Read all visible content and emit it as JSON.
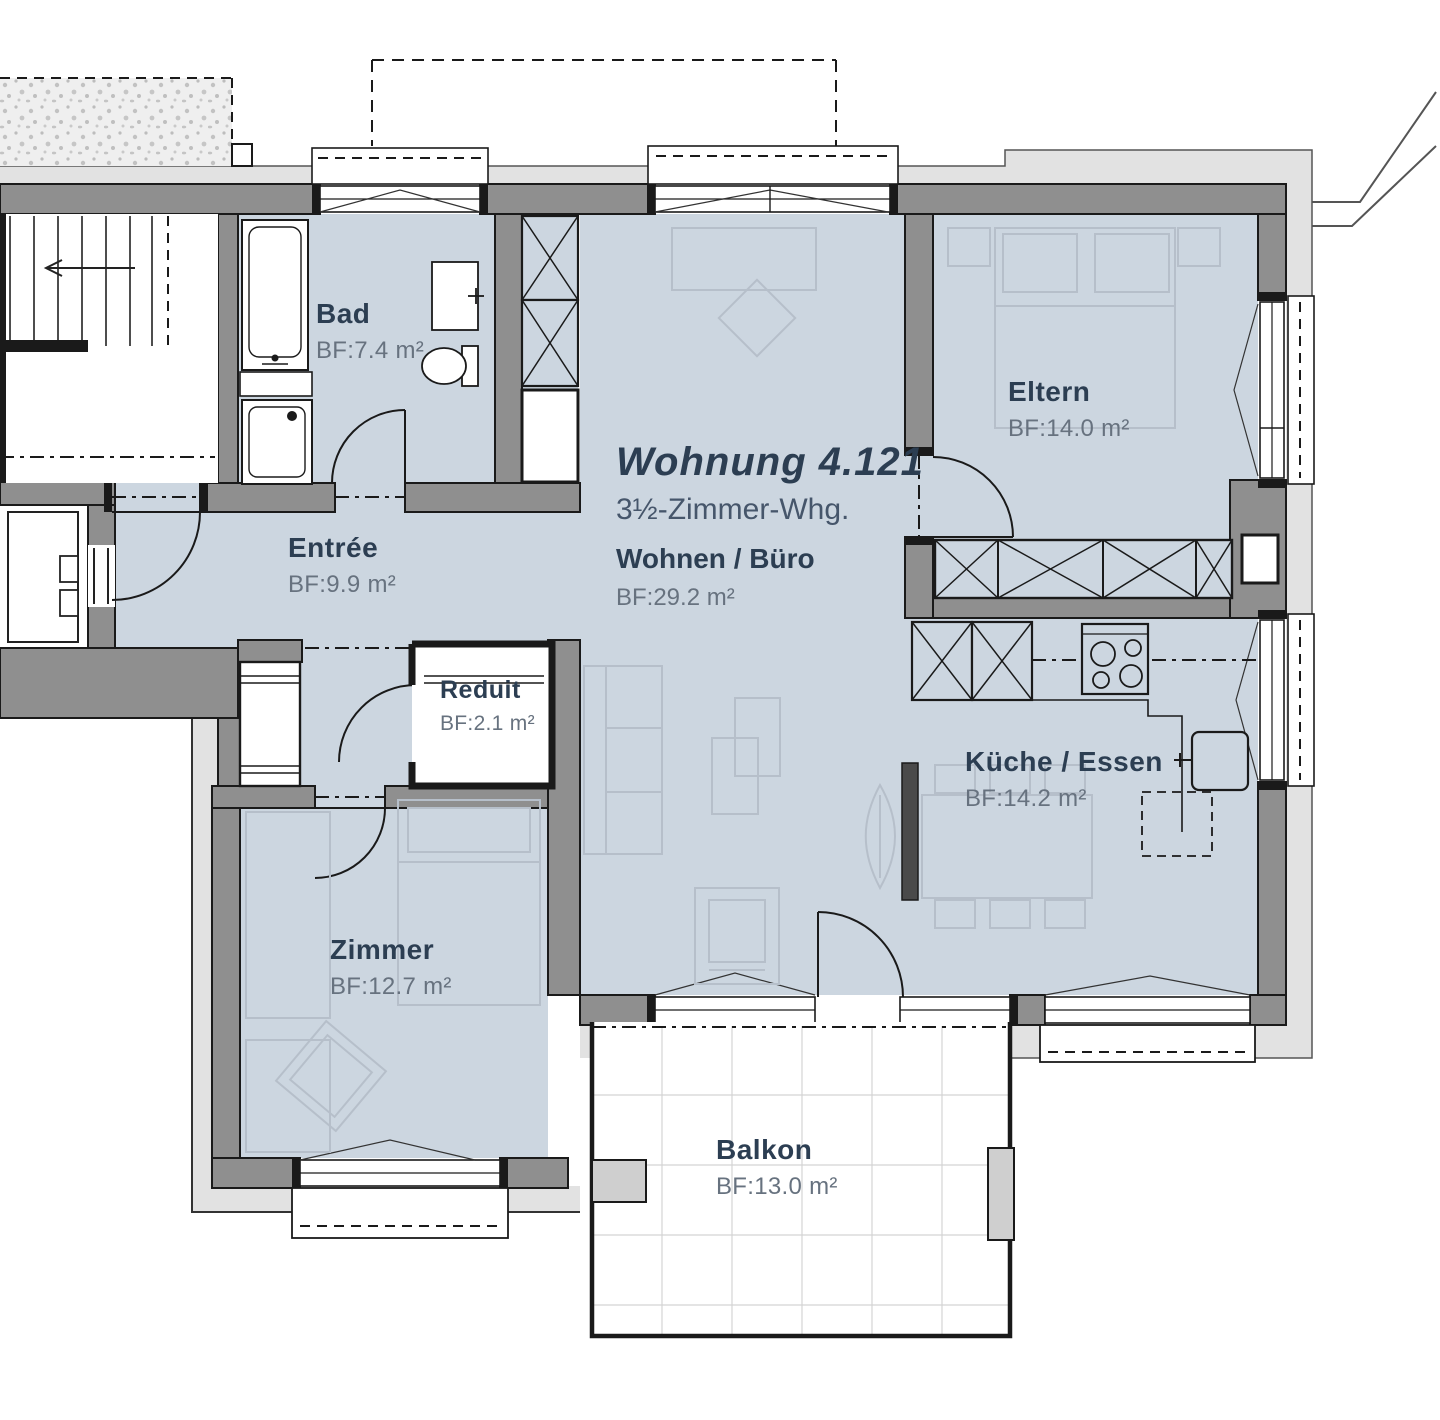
{
  "plan": {
    "title": "Wohnung 4.121",
    "subtitle": "3½-Zimmer-Whg."
  },
  "rooms": [
    {
      "id": "bad",
      "name": "Bad",
      "area": "BF:7.4 m²"
    },
    {
      "id": "entree",
      "name": "Entrée",
      "area": "BF:9.9 m²"
    },
    {
      "id": "reduit",
      "name": "Reduit",
      "area": "BF:2.1 m²"
    },
    {
      "id": "zimmer",
      "name": "Zimmer",
      "area": "BF:12.7 m²"
    },
    {
      "id": "wohnen",
      "name": "Wohnen / Büro",
      "area": "BF:29.2 m²"
    },
    {
      "id": "eltern",
      "name": "Eltern",
      "area": "BF:14.0 m²"
    },
    {
      "id": "kueche",
      "name": "Küche / Essen",
      "area": "BF:14.2 m²"
    },
    {
      "id": "balkon",
      "name": "Balkon",
      "area": "BF:13.0 m²"
    }
  ],
  "colors": {
    "room_fill": "#ccd6e0",
    "wall": "#8f8f8f",
    "facade": "#e2e2e2",
    "line": "#1a1a1a",
    "furniture": "#b6bfca",
    "label": "#2c3e52",
    "area_label": "#67727f",
    "grid": "#d4d4d4"
  }
}
